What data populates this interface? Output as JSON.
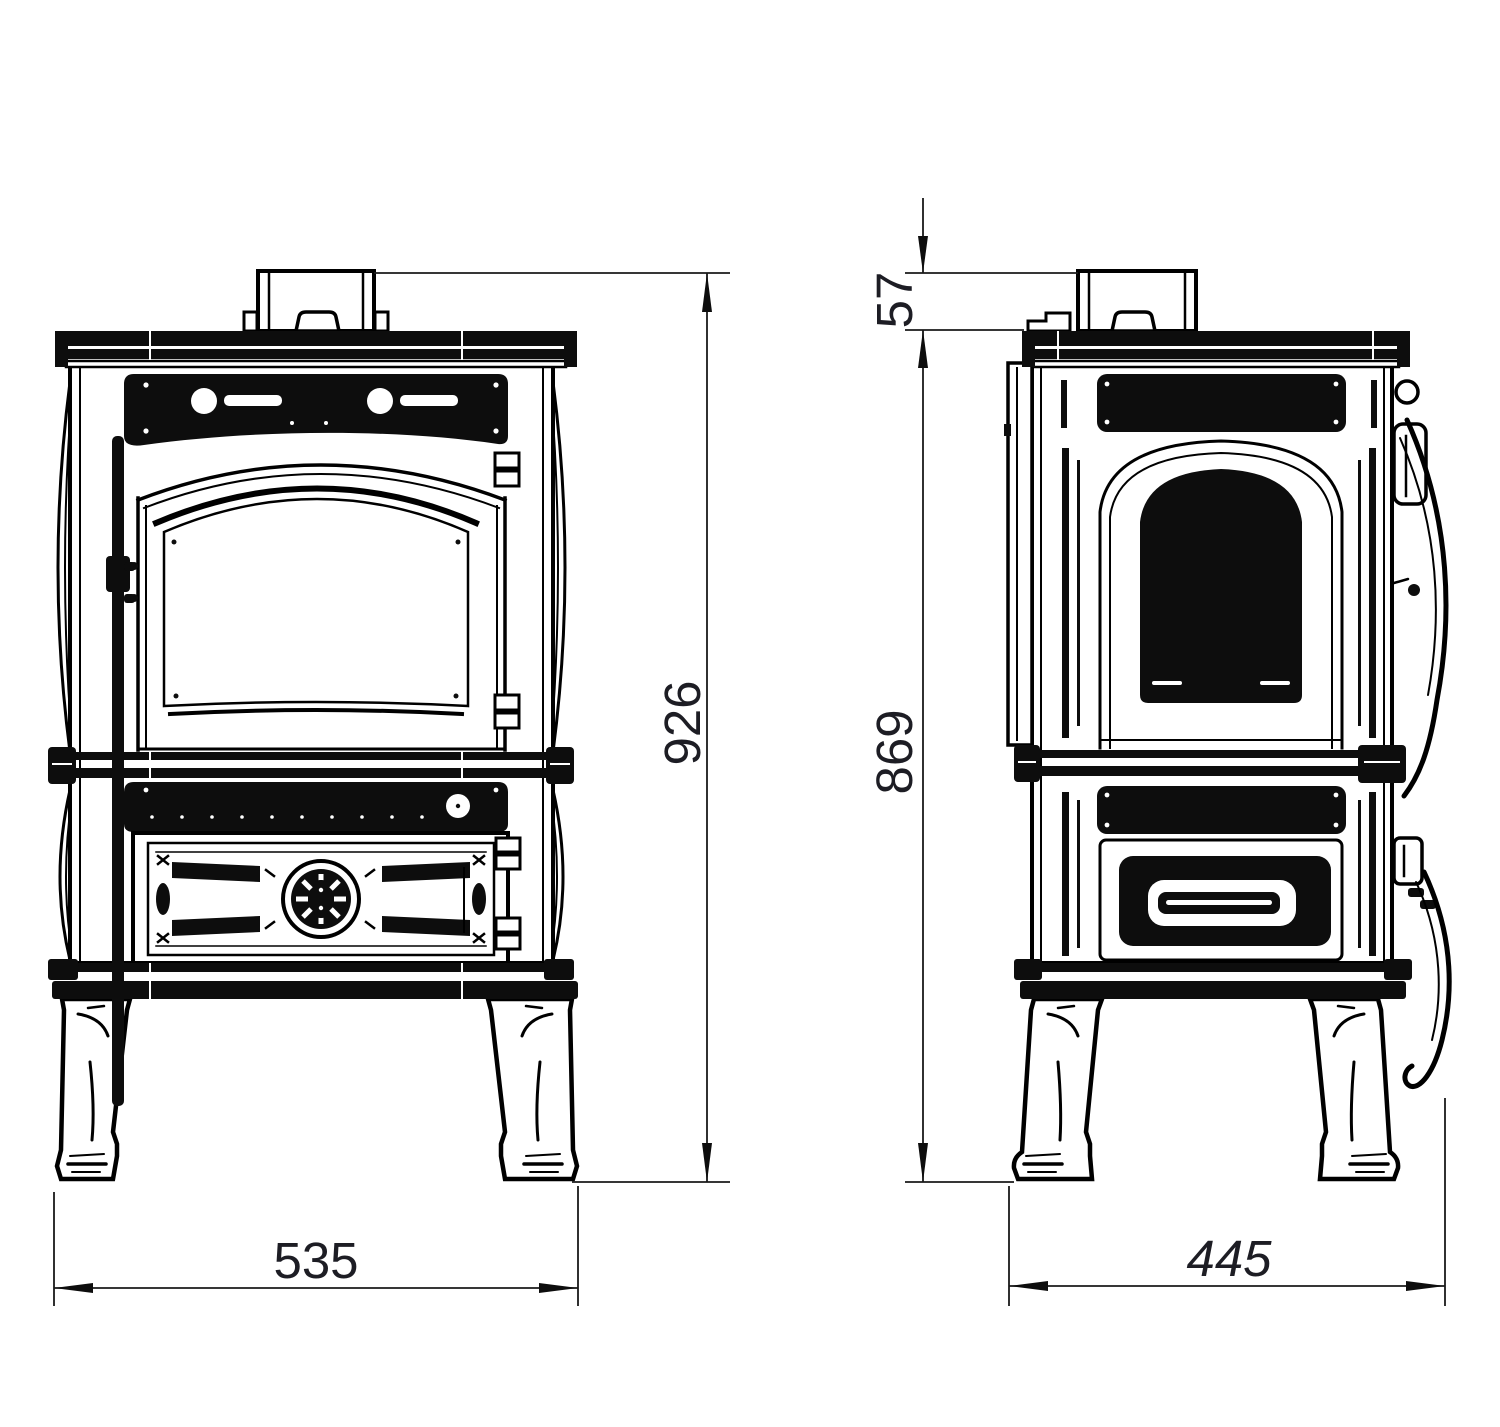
{
  "drawing": {
    "type": "technical-dimension-drawing",
    "subject": "cast-iron wood-burning stove, front and side elevation views",
    "units": "mm",
    "background_color": "#ffffff",
    "line_color": "#000000",
    "views": {
      "front": {
        "label": "front elevation",
        "width_mm": 535,
        "overall_height_mm": 926
      },
      "side": {
        "label": "side elevation",
        "depth_mm": 445,
        "body_height_mm": 869,
        "flue_collar_height_mm": 57
      }
    },
    "dimensions": {
      "front_width": "535",
      "overall_height": "926",
      "flue_collar_height": "57",
      "body_height": "869",
      "depth": "445"
    }
  }
}
